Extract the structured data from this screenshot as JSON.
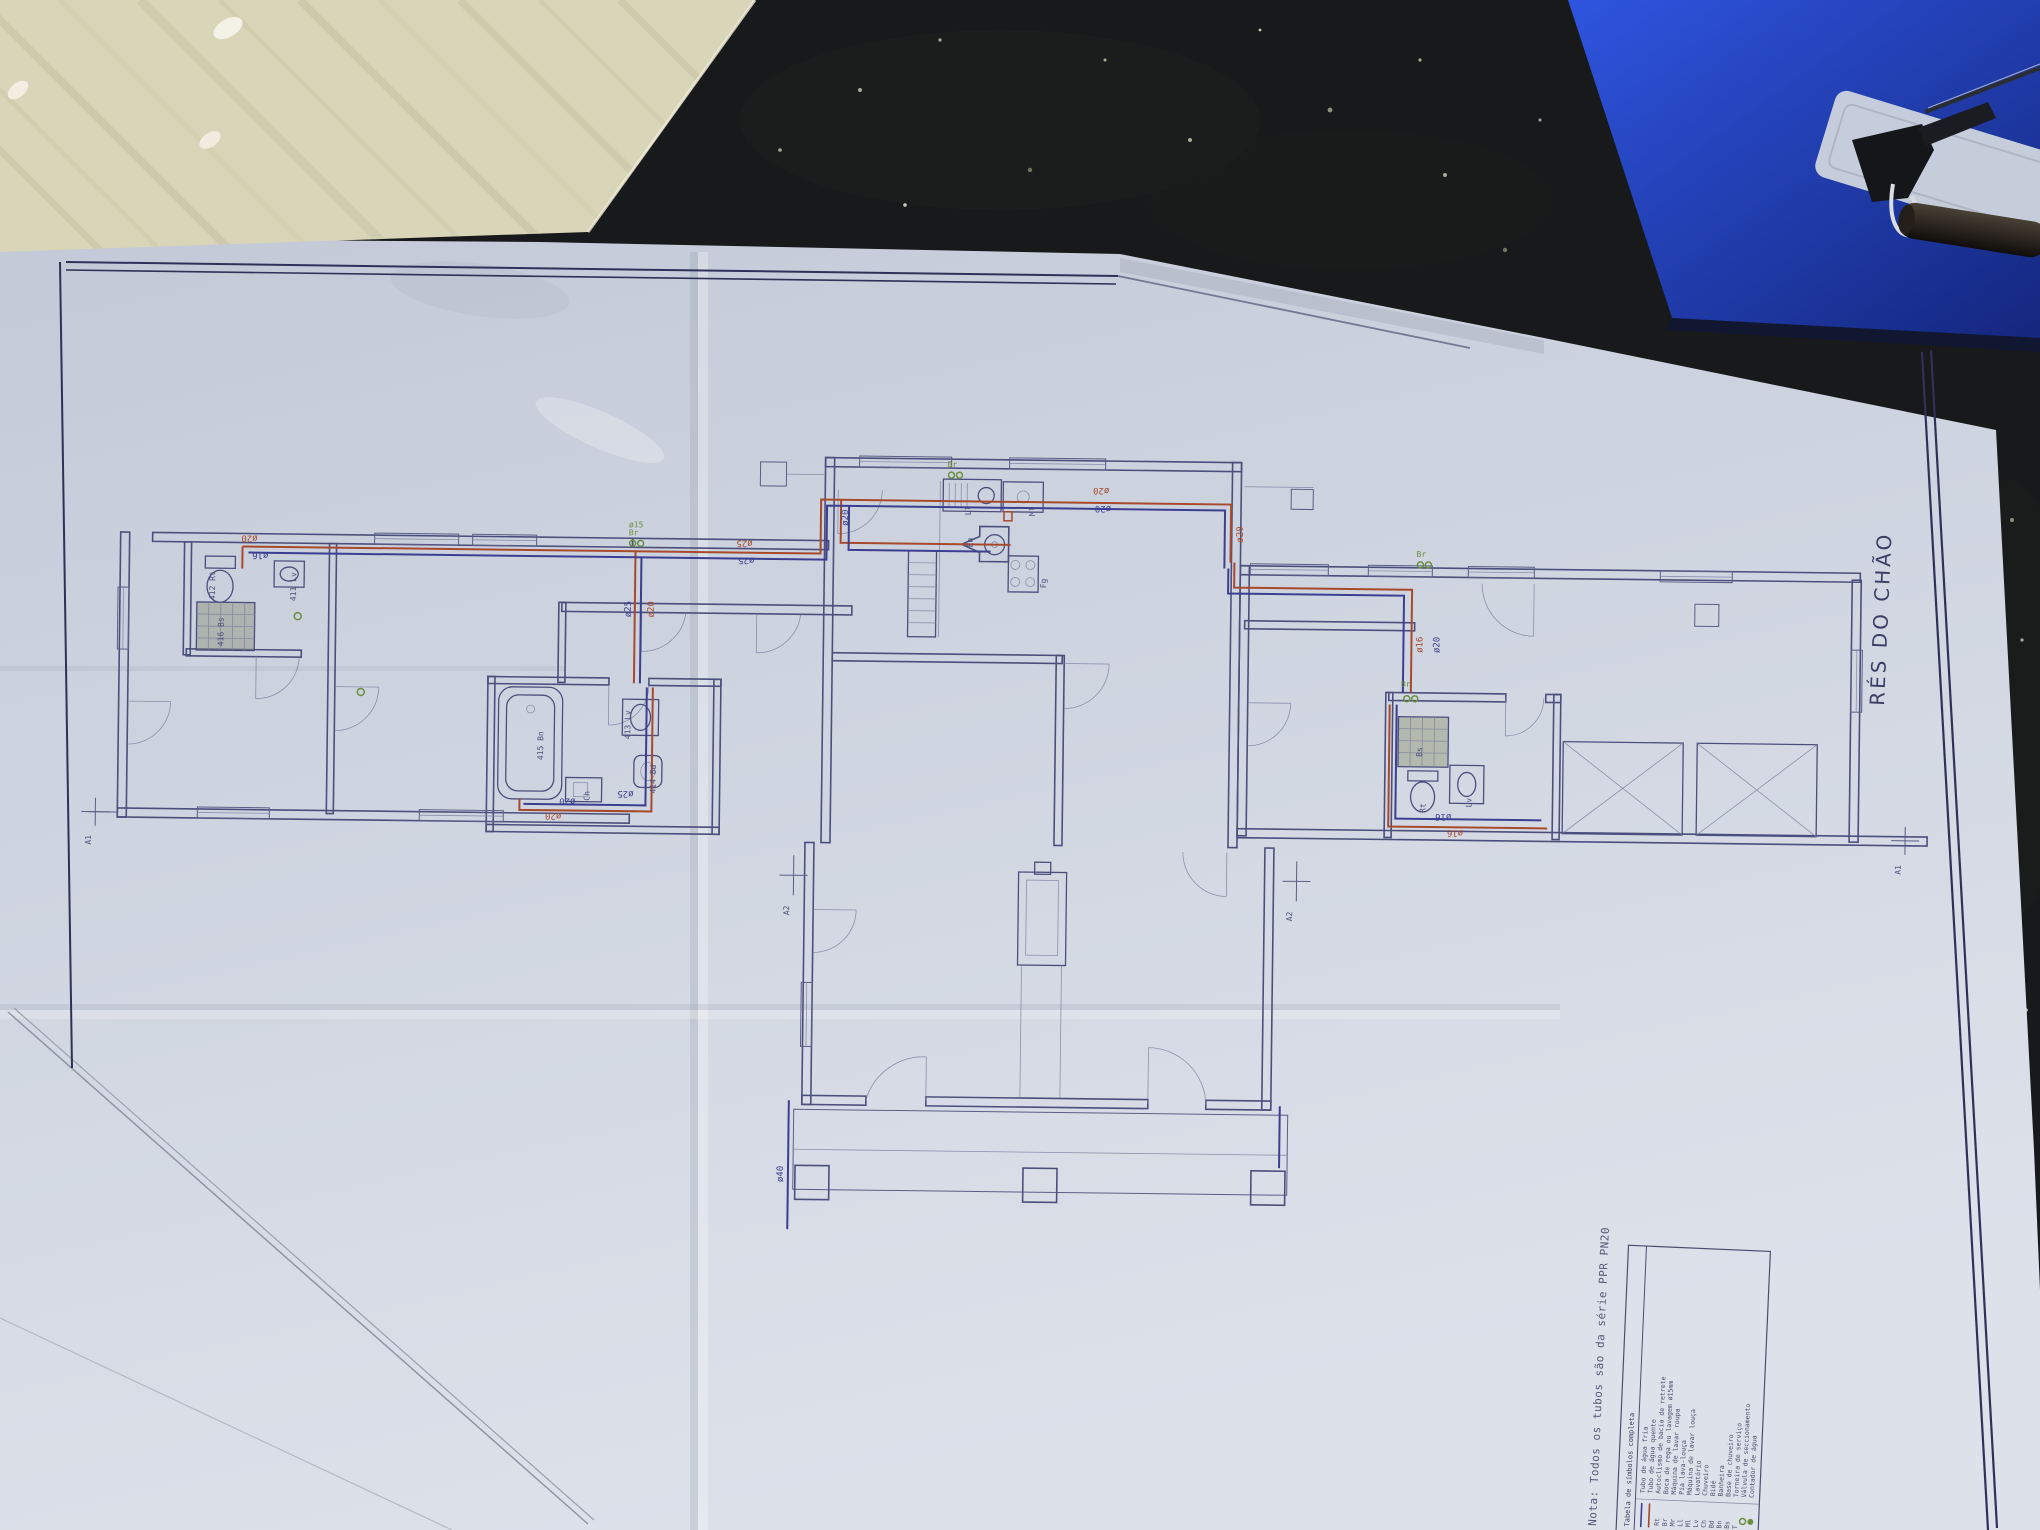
{
  "scene": {
    "colors": {
      "table": "#17191b",
      "cardboard": "#d9d5b8",
      "folder_blue": "#1e3eb8",
      "paper": "#cfd5e0",
      "plan_line": "#4b4f7d",
      "pipe_hot": "#a8492c",
      "pipe_cold": "#3c3e90",
      "accent_green": "#6b8f3f",
      "border_navy": "#2e3158"
    }
  },
  "sheet": {
    "title": "RÉS DO CHÃO",
    "note": "Nota: Todos os tubos são da série PPR PN20",
    "legend": {
      "header": "Tabela de símbolos completa",
      "rows": [
        {
          "abbr": "",
          "label": "Tubo de água fria"
        },
        {
          "abbr": "",
          "label": "Tubo de água quente"
        },
        {
          "abbr": "Rt",
          "label": "Autoclismo de bacia de retrete"
        },
        {
          "abbr": "Br",
          "label": "Boca de rega ou lavagem ø15mm"
        },
        {
          "abbr": "Mr",
          "label": "Máquina de lavar roupa"
        },
        {
          "abbr": "Ll",
          "label": "Pia lava-louça"
        },
        {
          "abbr": "Ml",
          "label": "Máquina de lavar louça"
        },
        {
          "abbr": "Lv",
          "label": "Lavatório"
        },
        {
          "abbr": "Ch",
          "label": "Chuveiro"
        },
        {
          "abbr": "Bd",
          "label": "Bidé"
        },
        {
          "abbr": "Bn",
          "label": "Banheira"
        },
        {
          "abbr": "Bs",
          "label": "Base de chuveiro"
        },
        {
          "abbr": "T",
          "label": "Torneira de serviço"
        },
        {
          "abbr": "",
          "label": "Válvula de seccionamento"
        },
        {
          "abbr": "",
          "label": "Contador de água"
        }
      ]
    },
    "markers": {
      "a1": "A1",
      "a2": "A2"
    },
    "pipe_labels": {
      "d15": "ø15",
      "d16": "ø16",
      "d20": "ø20",
      "d25": "ø25",
      "d40": "ø40"
    },
    "valve_br": "Br",
    "fixtures": {
      "bn": "415 Bn",
      "lv": "413 Lv",
      "bd": "414 Bd",
      "ch_cab": "Ch",
      "rt_l": "412 Rt",
      "bs_l": "416 Bs",
      "lv_l": "411 Lv",
      "bs_r": "Bs",
      "rt_r": "Rt",
      "lv_r": "Lv",
      "ll": "Ll",
      "ml": "Ml",
      "eq": "Eq",
      "fg": "Fg"
    }
  }
}
